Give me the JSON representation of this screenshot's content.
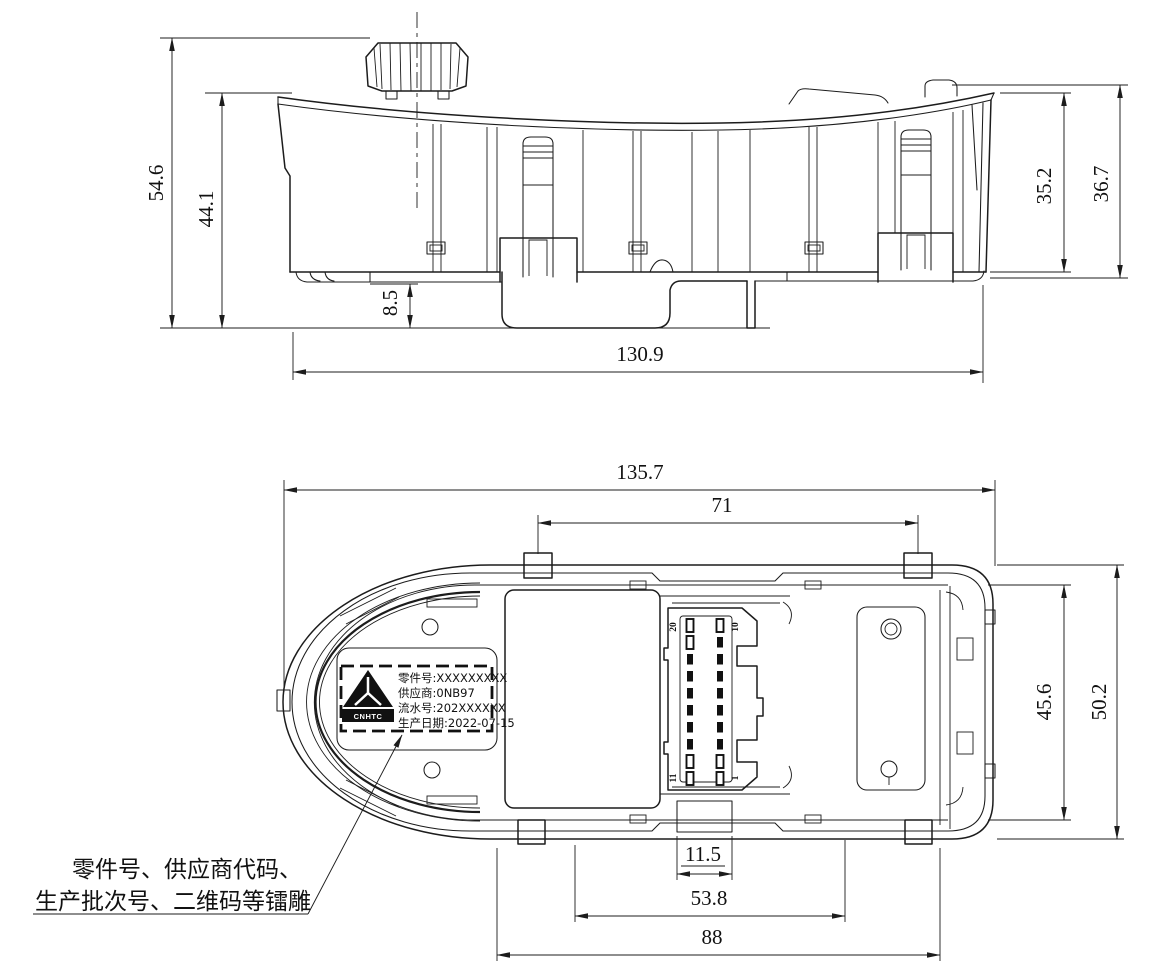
{
  "page": {
    "background": "#ffffff",
    "line_color": "#1c1c1c"
  },
  "top_view": {
    "description": "side elevation of switch panel",
    "dims": {
      "total_height": "54.6",
      "body_height": "44.1",
      "skirt_height": "8.5",
      "total_width": "130.9",
      "right_height_inner": "35.2",
      "right_height_outer": "36.7"
    }
  },
  "bottom_view": {
    "description": "bottom plan view of switch panel",
    "dims": {
      "total_width": "135.7",
      "tab_spacing": "71",
      "inner_height": "45.6",
      "total_height": "50.2",
      "connector_tab_width": "11.5",
      "connector_width": "53.8",
      "mount_width": "88"
    },
    "label": {
      "logo_text": "CNHTC",
      "part_no": "零件号:XXXXXXXXX",
      "supplier": "供应商:0NB97",
      "serial": "流水号:202XXXXXX",
      "date": "生产日期:2022-07-15"
    },
    "connector": {
      "pin_top_left": "20",
      "pin_top_right": "10",
      "pin_bottom_left": "11",
      "pin_bottom_right": "1"
    }
  },
  "annotation": {
    "line1": "零件号、供应商代码、",
    "line2": "生产批次号、二维码等镭雕"
  }
}
